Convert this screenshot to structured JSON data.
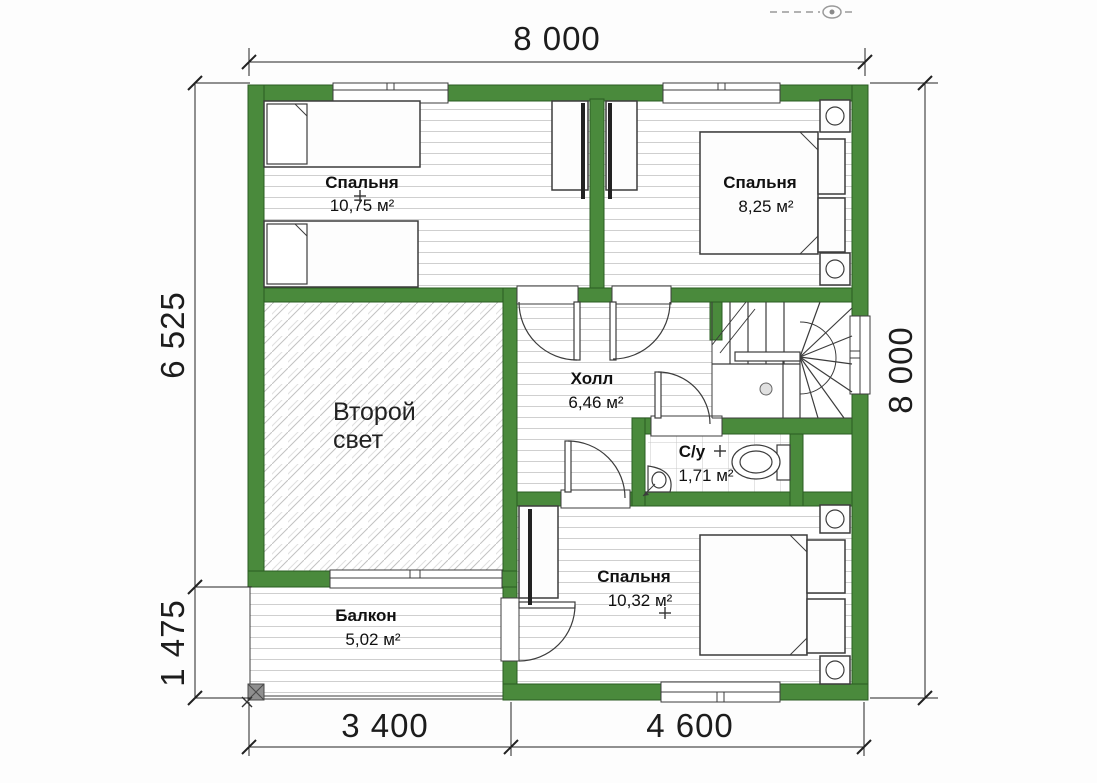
{
  "plan_title": "floor-plan-level-2",
  "dimensions": {
    "top": "8 000",
    "right": "8 000",
    "left_upper": "6 525",
    "left_lower": "1 475",
    "bottom_left": "3 400",
    "bottom_right": "4 600"
  },
  "rooms": [
    {
      "id": "bedroom-top-left",
      "name": "Спальня",
      "area": "10,75 м²"
    },
    {
      "id": "bedroom-top-right",
      "name": "Спальня",
      "area": "8,25 м²"
    },
    {
      "id": "hall",
      "name": "Холл",
      "area": "6,46 м²"
    },
    {
      "id": "second-light",
      "name": "Второй свет",
      "line1": "Второй",
      "line2": "свет"
    },
    {
      "id": "bathroom",
      "name": "С/у",
      "area": "1,71 м²"
    },
    {
      "id": "bedroom-bottom",
      "name": "Спальня",
      "area": "10,32 м²"
    },
    {
      "id": "balcony",
      "name": "Балкон",
      "area": "5,02 м²"
    }
  ],
  "colors": {
    "wall": "#4a8a3c",
    "wall_outline": "#2a5c22",
    "drawing_line": "#3c3c3c",
    "floor_line": "#cfcfcf",
    "dimension_text": "#1c1c1c"
  },
  "icons": {
    "watermark": "eye-icon"
  }
}
